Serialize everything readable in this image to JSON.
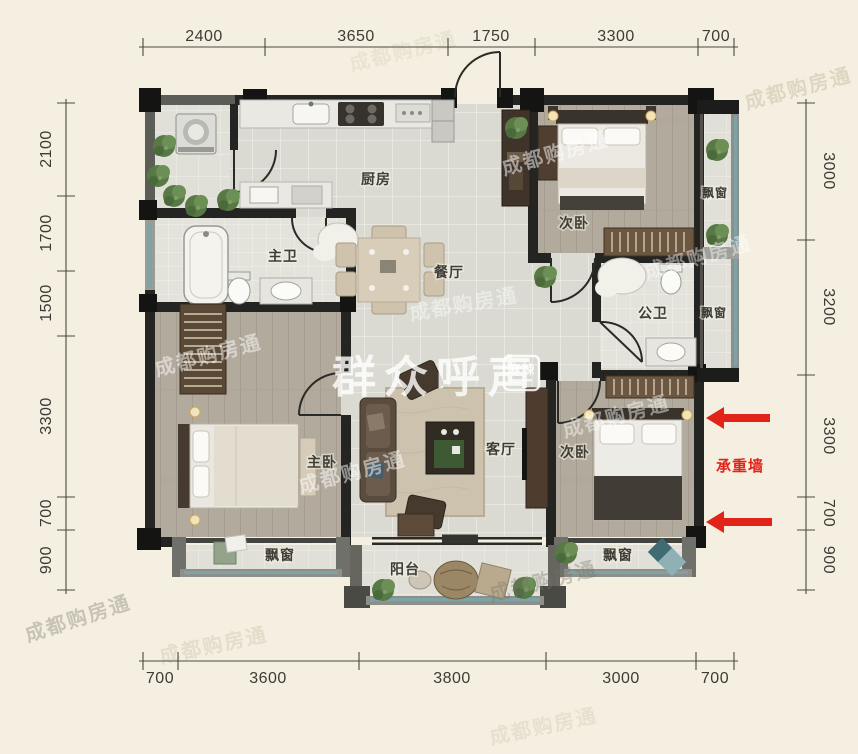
{
  "dimensions": {
    "top": [
      "2400",
      "3650",
      "1750",
      "3300",
      "700"
    ],
    "bottom": [
      "700",
      "3600",
      "3800",
      "3000",
      "700"
    ],
    "left": [
      "2100",
      "1700",
      "1500",
      "3300",
      "700",
      "900"
    ],
    "right": [
      "3000",
      "3200",
      "3300",
      "700",
      "900"
    ]
  },
  "rooms": {
    "kitchen": "厨房",
    "dining": "餐厅",
    "living": "客厅",
    "master_bedroom": "主卧",
    "bedroom_top": "次卧",
    "bedroom_bottom": "次卧",
    "master_bath": "主卫",
    "public_bath": "公卫",
    "balcony": "阳台",
    "bay_window": "飘窗"
  },
  "annotations": {
    "load_bearing_wall": "承重墙"
  },
  "watermarks": {
    "brand_large": "群众呼声",
    "brand_logo": "麻辣",
    "diagonal": "成都购房通"
  },
  "colors": {
    "background": "#f4efe1",
    "wall_dark": "#242422",
    "wall_gray": "#5d5d57",
    "window_teal": "#7ca3a8",
    "wood_floor": "#b2aa9c",
    "tile_floor": "#dadad2",
    "annotation_red": "#e2231a"
  }
}
